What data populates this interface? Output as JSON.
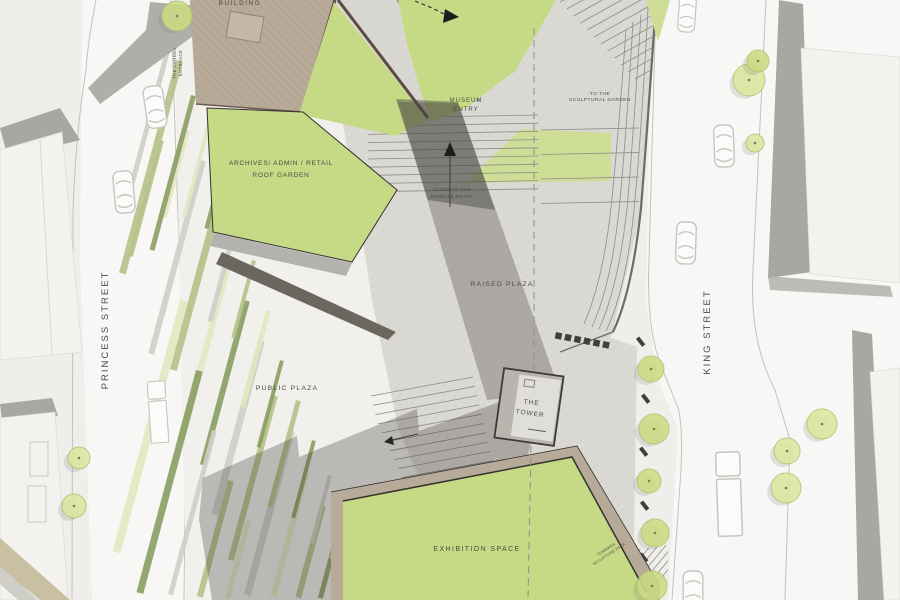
{
  "title": "Museum site plan",
  "streets": {
    "left": "PRINCESS STREET",
    "right": "KING STREET"
  },
  "labels": {
    "building": "BUILDING",
    "garden_l1": "THE GARDEN",
    "garden_l2": "ENTRANCE",
    "museum_l1": "MUSEUM",
    "museum_l2": "ENTRY",
    "to_l1": "TO THE",
    "to_l2": "SCULPTURAL GARDEN",
    "archives_l1": "ARCHIVES/ ADMIN / RETAIL",
    "archives_l2": "ROOF GARDEN",
    "steps_l1": "STEPS TO THE",
    "steps_l2": "MUSEUM ENTRY",
    "raised_plaza": "RAISED PLAZA",
    "public_plaza": "PUBLIC PLAZA",
    "tower_l1": "THE",
    "tower_l2": "TOWER",
    "exhibition": "EXHIBITION SPACE",
    "towards_l1": "TOWARDS",
    "towards_l2": "SCULPTURE PARK"
  },
  "icons": {
    "route_arrow": "dashed-route-arrow",
    "steps_arrow": "up-steps-arrow"
  },
  "palette": {
    "paper": "#efeeeb",
    "street": "#f8f7f5",
    "face": "#f3f2ef",
    "bshadow": "#a9a7a2",
    "paving": "#dbd9d3",
    "grain": "#c7c5bf",
    "green": "#c6d985",
    "green2": "#cede96",
    "s0": "#e2e7c0",
    "s1": "#b2c187",
    "s2": "#8a9d62",
    "s3": "#cfcec7",
    "tan": "#b7aa98",
    "brown": "#5d4a40",
    "ink": "#4b4a45",
    "tower_face": "#e0ded8",
    "tower_side": "#b9b5ae",
    "tower_outline": "#3c3b38",
    "dash": "#8f8d88",
    "car": "#c6c5c1",
    "stair": "#8e8c86",
    "tree_fill": "#dde6a0",
    "tree_fill2": "#ccdc84",
    "tree_edge": "#b3c276",
    "wall": "#6f6c67",
    "shadow": "rgba(62,60,56,0.30)"
  }
}
